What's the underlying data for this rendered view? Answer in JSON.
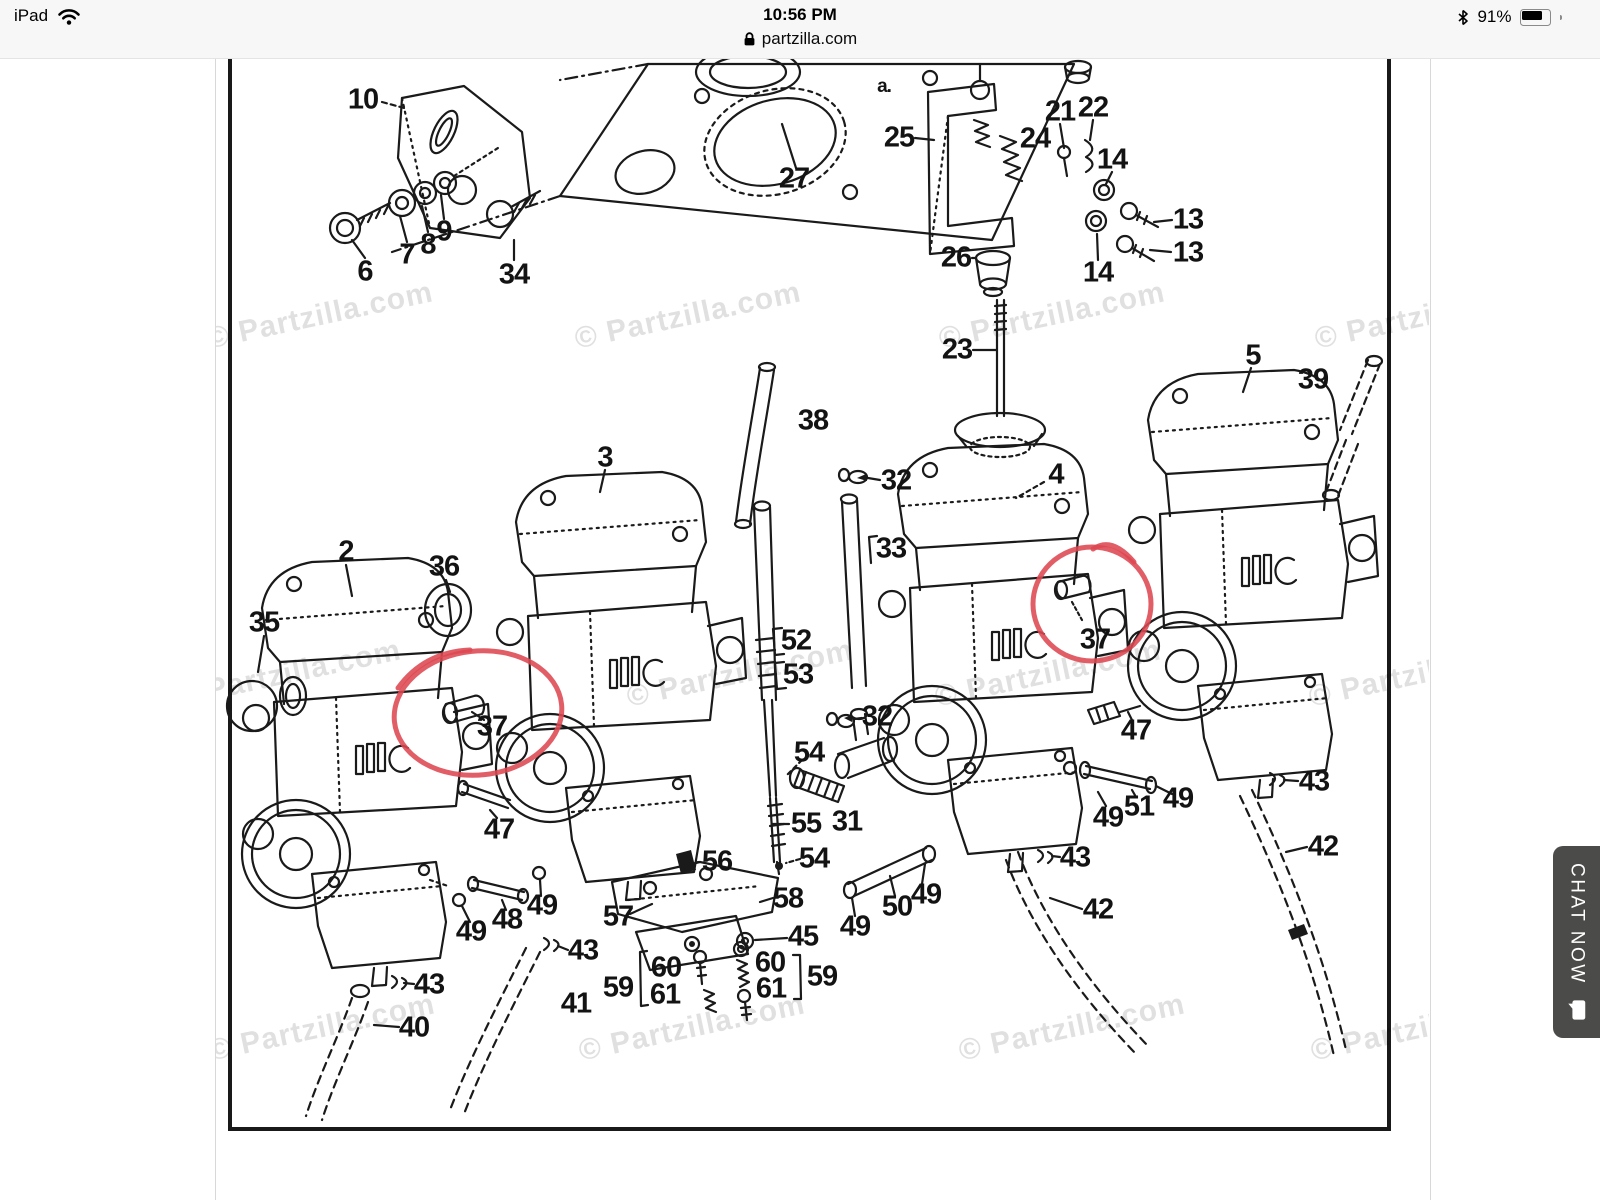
{
  "status_bar": {
    "carrier": "iPad",
    "time": "10:56 PM",
    "battery_percent": "91%"
  },
  "browser_bar": {
    "domain": "partzilla.com"
  },
  "chat_button": {
    "label": "CHAT NOW"
  },
  "icons": {
    "wifi-icon": "wifi-arcs",
    "bluetooth-icon": "bluetooth-rune",
    "battery-icon": "battery-nearly-full",
    "lock-icon": "padlock",
    "chat-bubble-icon": "speech-bubble"
  },
  "diagram": {
    "ink_color": "#1a1a1a",
    "annotation_color": "#dd4852",
    "watermark_text": "© Partzilla.com",
    "watermarks": [
      {
        "x": 320,
        "y": 316
      },
      {
        "x": 688,
        "y": 316
      },
      {
        "x": 1052,
        "y": 316
      },
      {
        "x": 1428,
        "y": 316
      },
      {
        "x": 288,
        "y": 674
      },
      {
        "x": 740,
        "y": 674
      },
      {
        "x": 1048,
        "y": 674
      },
      {
        "x": 1422,
        "y": 674
      },
      {
        "x": 322,
        "y": 1028
      },
      {
        "x": 692,
        "y": 1028
      },
      {
        "x": 1072,
        "y": 1028
      },
      {
        "x": 1424,
        "y": 1028
      }
    ],
    "annotations": [
      {
        "shape": "ellipse",
        "cx": 478,
        "cy": 713,
        "rx": 84,
        "ry": 62,
        "rot": -6,
        "tail": "M398,688 Q424,652 470,650",
        "note": "hand-drawn circle around part 37 (left)"
      },
      {
        "shape": "ellipse",
        "cx": 1092,
        "cy": 604,
        "rx": 59,
        "ry": 57,
        "rot": 0,
        "tail": "M1093,549 Q1112,536 1134,562",
        "note": "hand-drawn circle around part 37 (right)"
      }
    ],
    "labels": [
      {
        "t": "10",
        "x": 363,
        "y": 100
      },
      {
        "t": "a.",
        "x": 884,
        "y": 87,
        "s": 19
      },
      {
        "t": "21",
        "x": 1060,
        "y": 112
      },
      {
        "t": "22",
        "x": 1093,
        "y": 108
      },
      {
        "t": "25",
        "x": 899,
        "y": 138
      },
      {
        "t": "24",
        "x": 1035,
        "y": 139
      },
      {
        "t": "14",
        "x": 1112,
        "y": 160
      },
      {
        "t": "27",
        "x": 794,
        "y": 179
      },
      {
        "t": "13",
        "x": 1188,
        "y": 220
      },
      {
        "t": "13",
        "x": 1188,
        "y": 253
      },
      {
        "t": "7",
        "x": 407,
        "y": 255
      },
      {
        "t": "8",
        "x": 428,
        "y": 245
      },
      {
        "t": "9",
        "x": 444,
        "y": 232
      },
      {
        "t": "6",
        "x": 365,
        "y": 272
      },
      {
        "t": "34",
        "x": 514,
        "y": 275
      },
      {
        "t": "26",
        "x": 956,
        "y": 258
      },
      {
        "t": "14",
        "x": 1098,
        "y": 273
      },
      {
        "t": "23",
        "x": 957,
        "y": 350
      },
      {
        "t": "5",
        "x": 1253,
        "y": 356
      },
      {
        "t": "39",
        "x": 1313,
        "y": 380
      },
      {
        "t": "38",
        "x": 813,
        "y": 421
      },
      {
        "t": "3",
        "x": 605,
        "y": 458
      },
      {
        "t": "32",
        "x": 896,
        "y": 481
      },
      {
        "t": "4",
        "x": 1056,
        "y": 475
      },
      {
        "t": "33",
        "x": 891,
        "y": 549
      },
      {
        "t": "2",
        "x": 346,
        "y": 552
      },
      {
        "t": "36",
        "x": 444,
        "y": 567
      },
      {
        "t": "35",
        "x": 264,
        "y": 623
      },
      {
        "t": "37",
        "x": 1095,
        "y": 640
      },
      {
        "t": "52",
        "x": 796,
        "y": 641
      },
      {
        "t": "53",
        "x": 798,
        "y": 675
      },
      {
        "t": "32",
        "x": 877,
        "y": 717
      },
      {
        "t": "37",
        "x": 492,
        "y": 727
      },
      {
        "t": "47",
        "x": 1136,
        "y": 731
      },
      {
        "t": "54",
        "x": 809,
        "y": 753
      },
      {
        "t": "43",
        "x": 1314,
        "y": 782
      },
      {
        "t": "49",
        "x": 1178,
        "y": 799
      },
      {
        "t": "51",
        "x": 1139,
        "y": 807
      },
      {
        "t": "49",
        "x": 1108,
        "y": 818
      },
      {
        "t": "55",
        "x": 806,
        "y": 824
      },
      {
        "t": "31",
        "x": 847,
        "y": 822
      },
      {
        "t": "47",
        "x": 499,
        "y": 830
      },
      {
        "t": "42",
        "x": 1323,
        "y": 847
      },
      {
        "t": "43",
        "x": 1075,
        "y": 858
      },
      {
        "t": "54",
        "x": 814,
        "y": 859
      },
      {
        "t": "56",
        "x": 717,
        "y": 862
      },
      {
        "t": "58",
        "x": 788,
        "y": 899
      },
      {
        "t": "49",
        "x": 926,
        "y": 895
      },
      {
        "t": "50",
        "x": 897,
        "y": 907
      },
      {
        "t": "42",
        "x": 1098,
        "y": 910
      },
      {
        "t": "49",
        "x": 542,
        "y": 906
      },
      {
        "t": "48",
        "x": 507,
        "y": 920
      },
      {
        "t": "57",
        "x": 618,
        "y": 917
      },
      {
        "t": "49",
        "x": 855,
        "y": 927
      },
      {
        "t": "49",
        "x": 471,
        "y": 932
      },
      {
        "t": "45",
        "x": 803,
        "y": 937
      },
      {
        "t": "43",
        "x": 583,
        "y": 951
      },
      {
        "t": "60",
        "x": 666,
        "y": 968
      },
      {
        "t": "61",
        "x": 665,
        "y": 995
      },
      {
        "t": "60",
        "x": 770,
        "y": 963
      },
      {
        "t": "61",
        "x": 771,
        "y": 989
      },
      {
        "t": "59",
        "x": 618,
        "y": 988
      },
      {
        "t": "59",
        "x": 822,
        "y": 977
      },
      {
        "t": "43",
        "x": 429,
        "y": 985
      },
      {
        "t": "41",
        "x": 576,
        "y": 1004
      },
      {
        "t": "40",
        "x": 414,
        "y": 1028
      }
    ]
  }
}
